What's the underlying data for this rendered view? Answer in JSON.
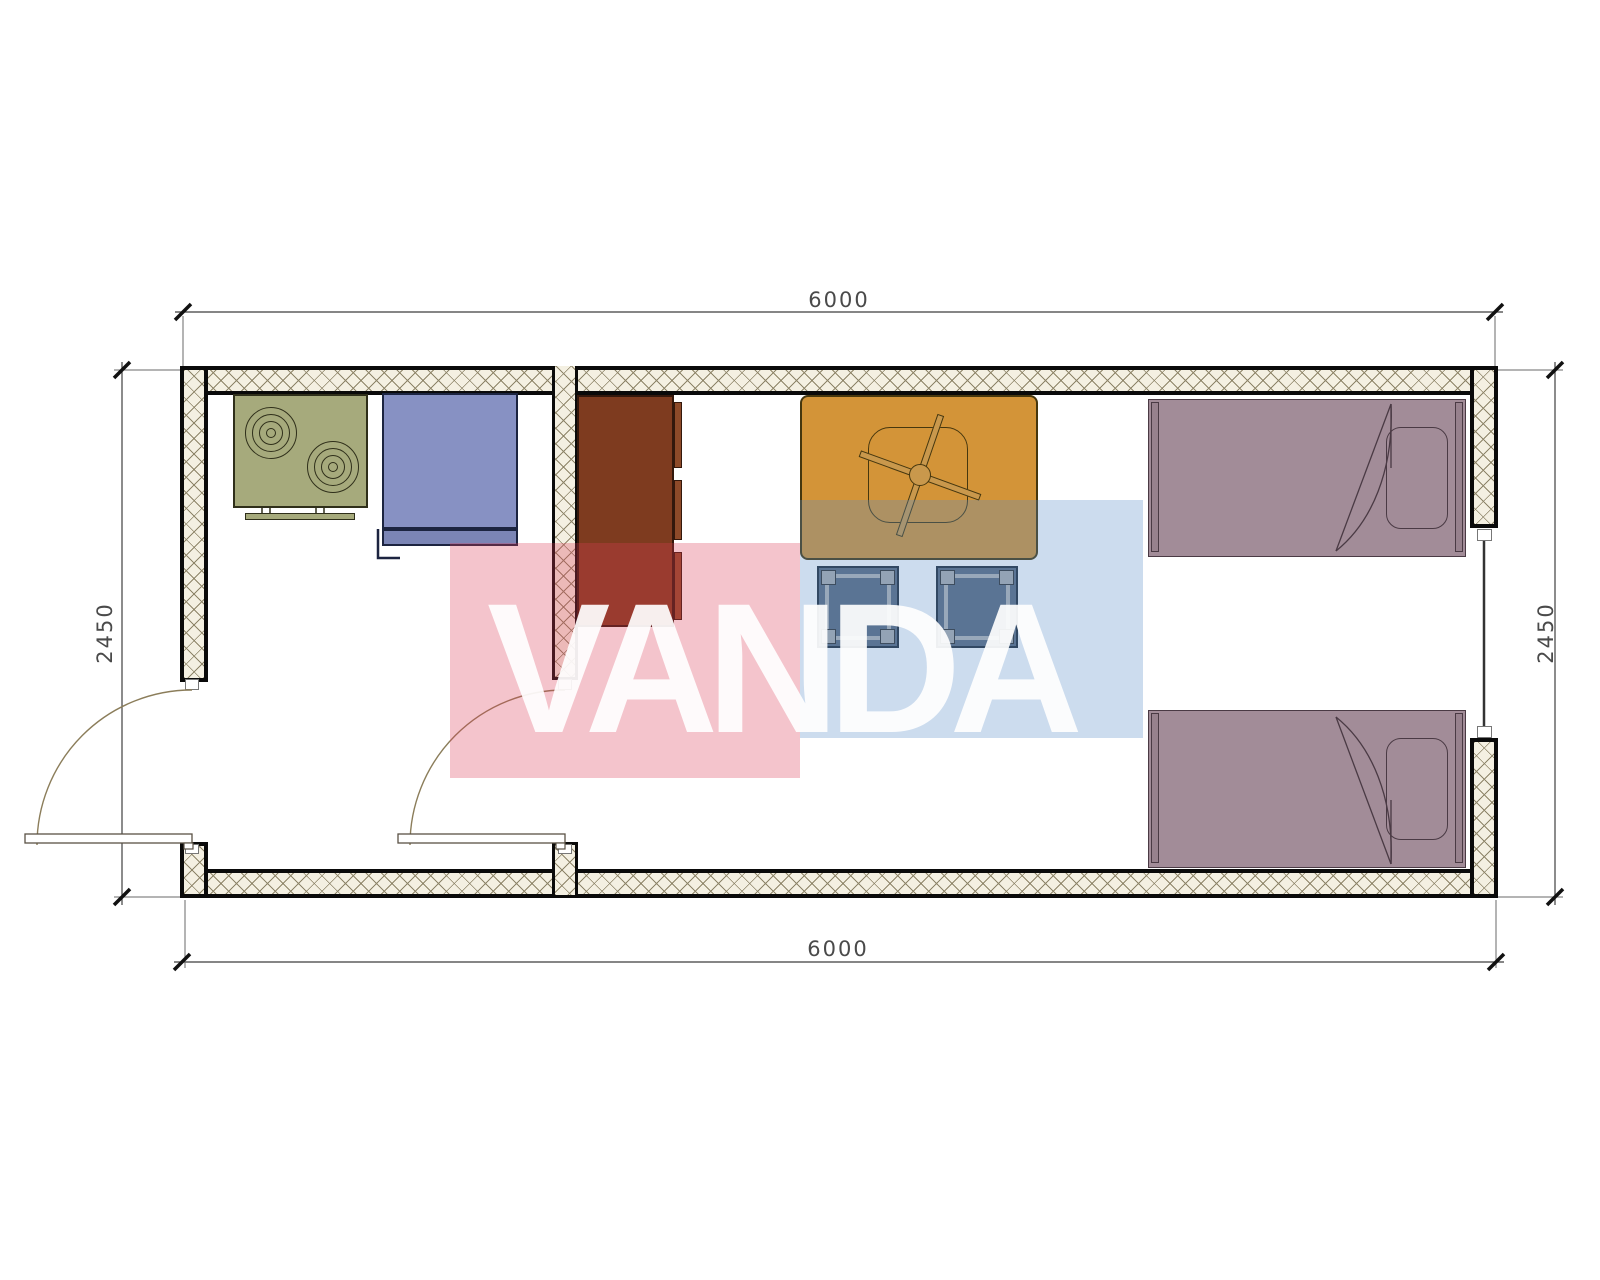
{
  "dimensions": {
    "top": {
      "label": "6000"
    },
    "bottom": {
      "label": "6000"
    },
    "left": {
      "label": "2450"
    },
    "right": {
      "label": "2450"
    }
  },
  "watermark": {
    "text": "VANDA",
    "red_color": "#dc3a55",
    "blue_color": "#558ac6",
    "text_color": "#ffffff"
  },
  "colors": {
    "wall_line": "#0a0a0a",
    "wall_hatch_bg": "#f4f0e2",
    "wall_hatch_line": "#8d8468",
    "stove": "#a6aa7c",
    "stove_line": "#2f2f1a",
    "sink": "#8791c3",
    "sink_front": "#7b85b5",
    "sink_line": "#1c2440",
    "wardrobe": "#7e3b1f",
    "wardrobe_door": "#8d4a29",
    "wardrobe_line": "#33180c",
    "table": "#d39438",
    "table_line": "#46370e",
    "stool": "#5c6a7f",
    "stool_frame": "#b5b5b5",
    "stool_line": "#222b38",
    "bed": "#a28c98",
    "bed_line": "#4a3a44",
    "door_arc": "#8b7d5a",
    "door_leaf_line": "#5a5245",
    "window_line": "#333333",
    "dim_line": "#3f3f3f",
    "dim_text": "#4a4a4a",
    "wm_red": "#dc3a55",
    "wm_blue": "#558ac6",
    "wm_text": "#ffffff"
  },
  "furniture_symbols": [
    {
      "name": "stove"
    },
    {
      "name": "sink-unit"
    },
    {
      "name": "wardrobe"
    },
    {
      "name": "table-with-fan"
    },
    {
      "name": "stool"
    },
    {
      "name": "stool"
    },
    {
      "name": "single-bed"
    },
    {
      "name": "single-bed"
    }
  ]
}
